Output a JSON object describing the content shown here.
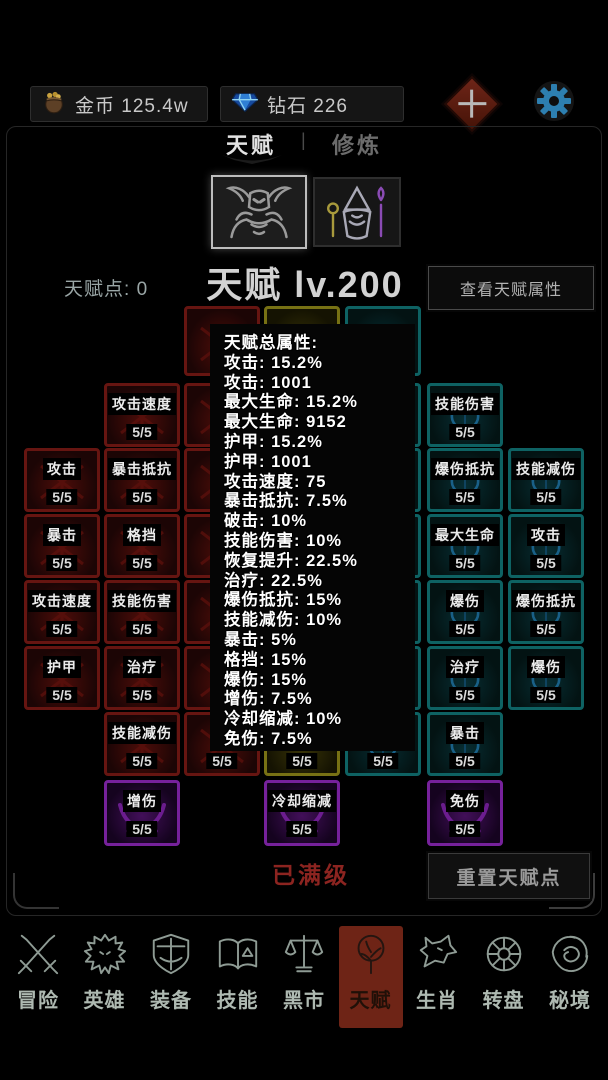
{
  "topbar": {
    "gold_label": "金币",
    "gold_value": "125.4w",
    "gem_label": "钻石",
    "gem_value": "226"
  },
  "tabs": {
    "active": "天赋",
    "divider": "|",
    "inactive": "修炼"
  },
  "characters": {
    "left_icon": "demon-warrior-icon",
    "right_icon": "wizard-icon"
  },
  "header": {
    "points_label": "天赋点:",
    "points_value": "0",
    "title": "天赋 lv.200",
    "view_attrs_button": "查看天赋属性"
  },
  "popup": {
    "lines": [
      "天赋总属性:",
      "攻击: 15.2%",
      "攻击: 1001",
      "最大生命: 15.2%",
      "最大生命: 9152",
      "护甲: 15.2%",
      "护甲: 1001",
      "攻击速度: 75",
      "暴击抵抗: 7.5%",
      "破击: 10%",
      "技能伤害: 10%",
      "恢复提升: 22.5%",
      "治疗: 22.5%",
      "爆伤抵抗: 15%",
      "技能减伤: 10%",
      "暴击: 5%",
      "格挡: 15%",
      "爆伤: 15%",
      "增伤: 7.5%",
      "冷却缩减: 10%",
      "免伤: 7.5%"
    ]
  },
  "talent_grid": {
    "nodes": [
      {
        "row": 0,
        "col": 3,
        "color": "red",
        "label": "",
        "value": ""
      },
      {
        "row": 0,
        "col": 4,
        "color": "yellow",
        "label": "",
        "value": ""
      },
      {
        "row": 0,
        "col": 5,
        "color": "teal",
        "label": "",
        "value": ""
      },
      {
        "row": 1,
        "col": 2,
        "color": "red",
        "label": "攻击速度",
        "value": "5/5"
      },
      {
        "row": 1,
        "col": 3,
        "color": "red",
        "label": "",
        "value": ""
      },
      {
        "row": 1,
        "col": 5,
        "color": "teal",
        "label": "",
        "value": ""
      },
      {
        "row": 1,
        "col": 6,
        "color": "teal",
        "label": "技能伤害",
        "value": "5/5"
      },
      {
        "row": 2,
        "col": 1,
        "color": "red",
        "label": "攻击",
        "value": "5/5"
      },
      {
        "row": 2,
        "col": 2,
        "color": "red",
        "label": "暴击抵抗",
        "value": "5/5"
      },
      {
        "row": 2,
        "col": 3,
        "color": "red",
        "label": "",
        "value": ""
      },
      {
        "row": 2,
        "col": 5,
        "color": "teal",
        "label": "",
        "value": ""
      },
      {
        "row": 2,
        "col": 6,
        "color": "teal",
        "label": "爆伤抵抗",
        "value": "5/5"
      },
      {
        "row": 2,
        "col": 7,
        "color": "teal",
        "label": "技能减伤",
        "value": "5/5"
      },
      {
        "row": 3,
        "col": 1,
        "color": "red",
        "label": "暴击",
        "value": "5/5"
      },
      {
        "row": 3,
        "col": 2,
        "color": "red",
        "label": "格挡",
        "value": "5/5"
      },
      {
        "row": 3,
        "col": 3,
        "color": "red",
        "label": "",
        "value": ""
      },
      {
        "row": 3,
        "col": 5,
        "color": "teal",
        "label": "",
        "value": ""
      },
      {
        "row": 3,
        "col": 6,
        "color": "teal",
        "label": "最大生命",
        "value": "5/5"
      },
      {
        "row": 3,
        "col": 7,
        "color": "teal",
        "label": "攻击",
        "value": "5/5"
      },
      {
        "row": 4,
        "col": 1,
        "color": "red",
        "label": "攻击速度",
        "value": "5/5"
      },
      {
        "row": 4,
        "col": 2,
        "color": "red",
        "label": "技能伤害",
        "value": "5/5"
      },
      {
        "row": 4,
        "col": 3,
        "color": "red",
        "label": "",
        "value": ""
      },
      {
        "row": 4,
        "col": 5,
        "color": "teal",
        "label": "",
        "value": ""
      },
      {
        "row": 4,
        "col": 6,
        "color": "teal",
        "label": "爆伤",
        "value": "5/5"
      },
      {
        "row": 4,
        "col": 7,
        "color": "teal",
        "label": "爆伤抵抗",
        "value": "5/5"
      },
      {
        "row": 5,
        "col": 1,
        "color": "red",
        "label": "护甲",
        "value": "5/5"
      },
      {
        "row": 5,
        "col": 2,
        "color": "red",
        "label": "治疗",
        "value": "5/5"
      },
      {
        "row": 5,
        "col": 3,
        "color": "red",
        "label": "",
        "value": ""
      },
      {
        "row": 5,
        "col": 5,
        "color": "teal",
        "label": "",
        "value": ""
      },
      {
        "row": 5,
        "col": 6,
        "color": "teal",
        "label": "治疗",
        "value": "5/5"
      },
      {
        "row": 5,
        "col": 7,
        "color": "teal",
        "label": "爆伤",
        "value": "5/5"
      },
      {
        "row": 6,
        "col": 2,
        "color": "red",
        "label": "技能减伤",
        "value": "5/5"
      },
      {
        "row": 6,
        "col": 3,
        "color": "red",
        "label": "",
        "value": "5/5"
      },
      {
        "row": 6,
        "col": 4,
        "color": "yellow",
        "label": "",
        "value": "5/5"
      },
      {
        "row": 6,
        "col": 5,
        "color": "teal",
        "label": "",
        "value": "5/5"
      },
      {
        "row": 6,
        "col": 6,
        "color": "teal",
        "label": "暴击",
        "value": "5/5"
      },
      {
        "row": 7,
        "col": 2,
        "color": "purple",
        "label": "增伤",
        "value": "5/5"
      },
      {
        "row": 7,
        "col": 4,
        "color": "purple",
        "label": "冷却缩减",
        "value": "5/5"
      },
      {
        "row": 7,
        "col": 6,
        "color": "purple",
        "label": "免伤",
        "value": "5/5"
      }
    ]
  },
  "footer": {
    "max_level_text": "已满级",
    "reset_button": "重置天赋点"
  },
  "nav": {
    "items": [
      {
        "label": "冒险",
        "icon": "crossed-swords-icon",
        "selected": false
      },
      {
        "label": "英雄",
        "icon": "dragon-head-icon",
        "selected": false
      },
      {
        "label": "装备",
        "icon": "shield-icon",
        "selected": false
      },
      {
        "label": "技能",
        "icon": "spellbook-icon",
        "selected": false
      },
      {
        "label": "黑市",
        "icon": "scales-icon",
        "selected": false
      },
      {
        "label": "天赋",
        "icon": "talent-tree-icon",
        "selected": true
      },
      {
        "label": "生肖",
        "icon": "wolf-icon",
        "selected": false
      },
      {
        "label": "转盘",
        "icon": "wheel-icon",
        "selected": false
      },
      {
        "label": "秘境",
        "icon": "vortex-icon",
        "selected": false
      }
    ]
  },
  "colors": {
    "nav_selected_bg": "#6e2416",
    "node_red": "#661511",
    "node_yellow": "#777114",
    "node_teal": "#0e6263",
    "node_purple": "#76219b",
    "gear_blue": "#2d7fb0",
    "max_level_red": "#8c2420"
  }
}
